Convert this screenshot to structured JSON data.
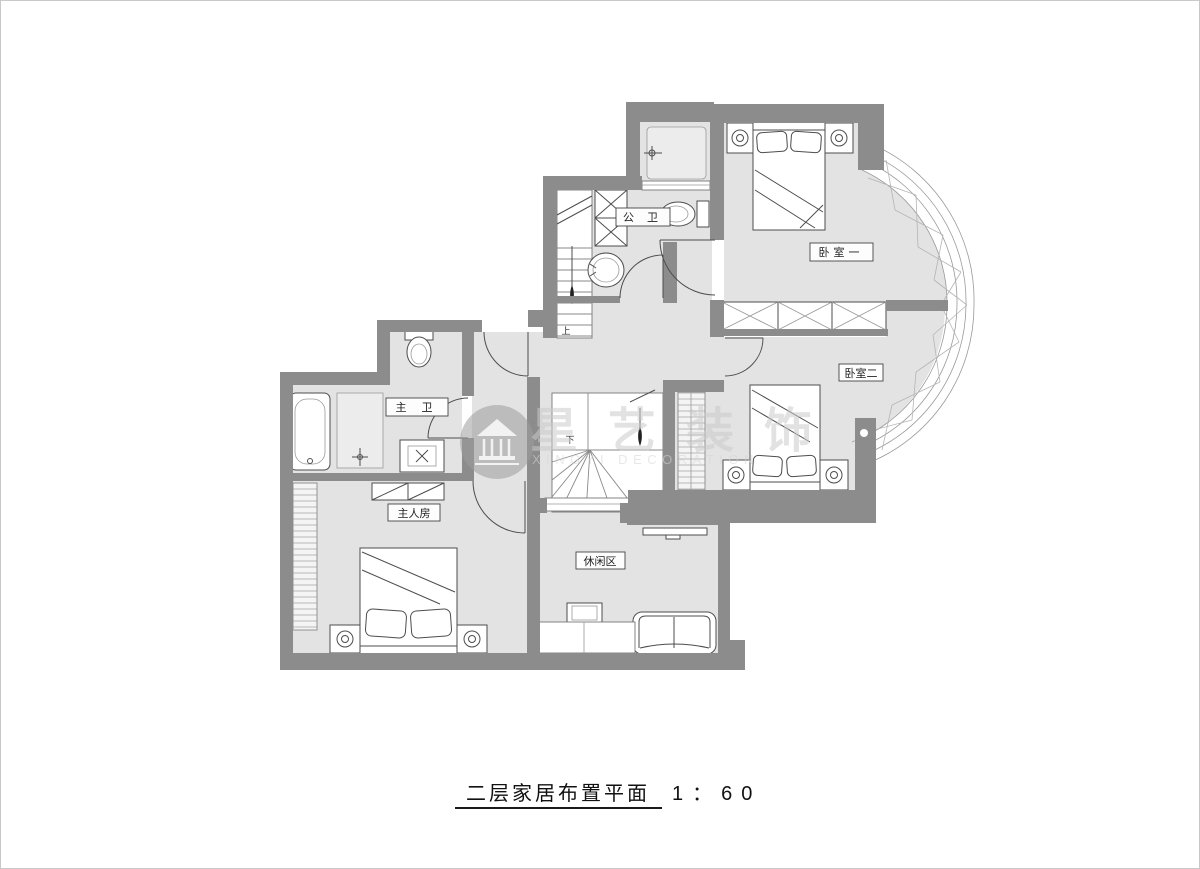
{
  "document": {
    "title": "二层家居布置平面",
    "scale": "1：60"
  },
  "rooms": {
    "bedroom1": "卧室一",
    "bedroom2": "卧室二",
    "master_bedroom": "主人房",
    "master_bath": "主 卫",
    "public_bath": "公 卫",
    "leisure": "休闲区"
  },
  "stairs": {
    "upper": "上",
    "lower": "下"
  },
  "watermark": {
    "brand": "星艺装饰",
    "brand_en": "XINGYI DECORATION"
  },
  "colors": {
    "wall": "#8c8c8c",
    "floor": "#e3e3e3",
    "accent_line": "#4d4d4d",
    "watermark": "#cbcbcb"
  }
}
